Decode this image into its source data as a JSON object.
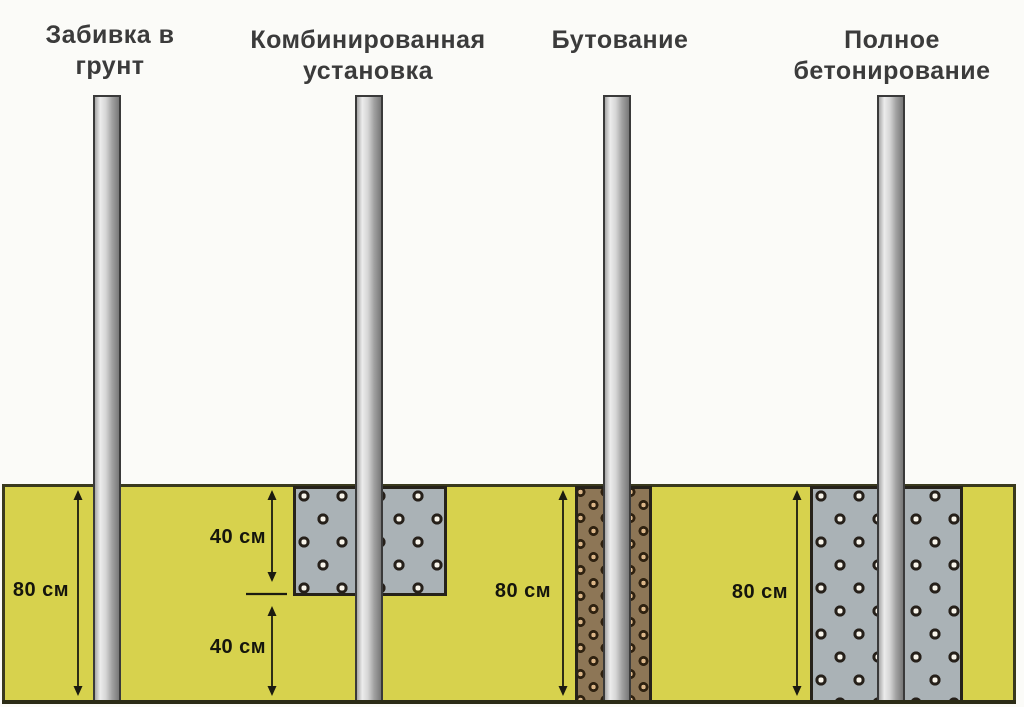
{
  "figure": {
    "description": "Fence post installation methods diagram",
    "methods": [
      {
        "name": "drive-into-ground",
        "title": "Забивка в\nгрунт",
        "depth_label": "80 см",
        "fill": "none"
      },
      {
        "name": "combined-installation",
        "title": "Комбинированная\nустановка",
        "upper_depth_label": "40 см",
        "lower_depth_label": "40 см",
        "upper_fill": "concrete",
        "lower_fill": "none"
      },
      {
        "name": "rubble-backfill",
        "title": "Бутование",
        "depth_label": "80 см",
        "fill": "rubble"
      },
      {
        "name": "full-concreting",
        "title": "Полное\nбетонирование",
        "depth_label": "80 см",
        "fill": "concrete"
      }
    ],
    "colors": {
      "ground": "#d7d24d",
      "ground_border": "#3a3a1e",
      "post_light": "#ececec",
      "post_dark": "#787878",
      "concrete": "#aab2b6",
      "concrete_aggregate": "#f8f4ea",
      "rubble": "#8d7656",
      "rubble_stone": "#dbb587",
      "dimension_line": "#1b1b10",
      "title_text": "#3b3b3b"
    }
  }
}
